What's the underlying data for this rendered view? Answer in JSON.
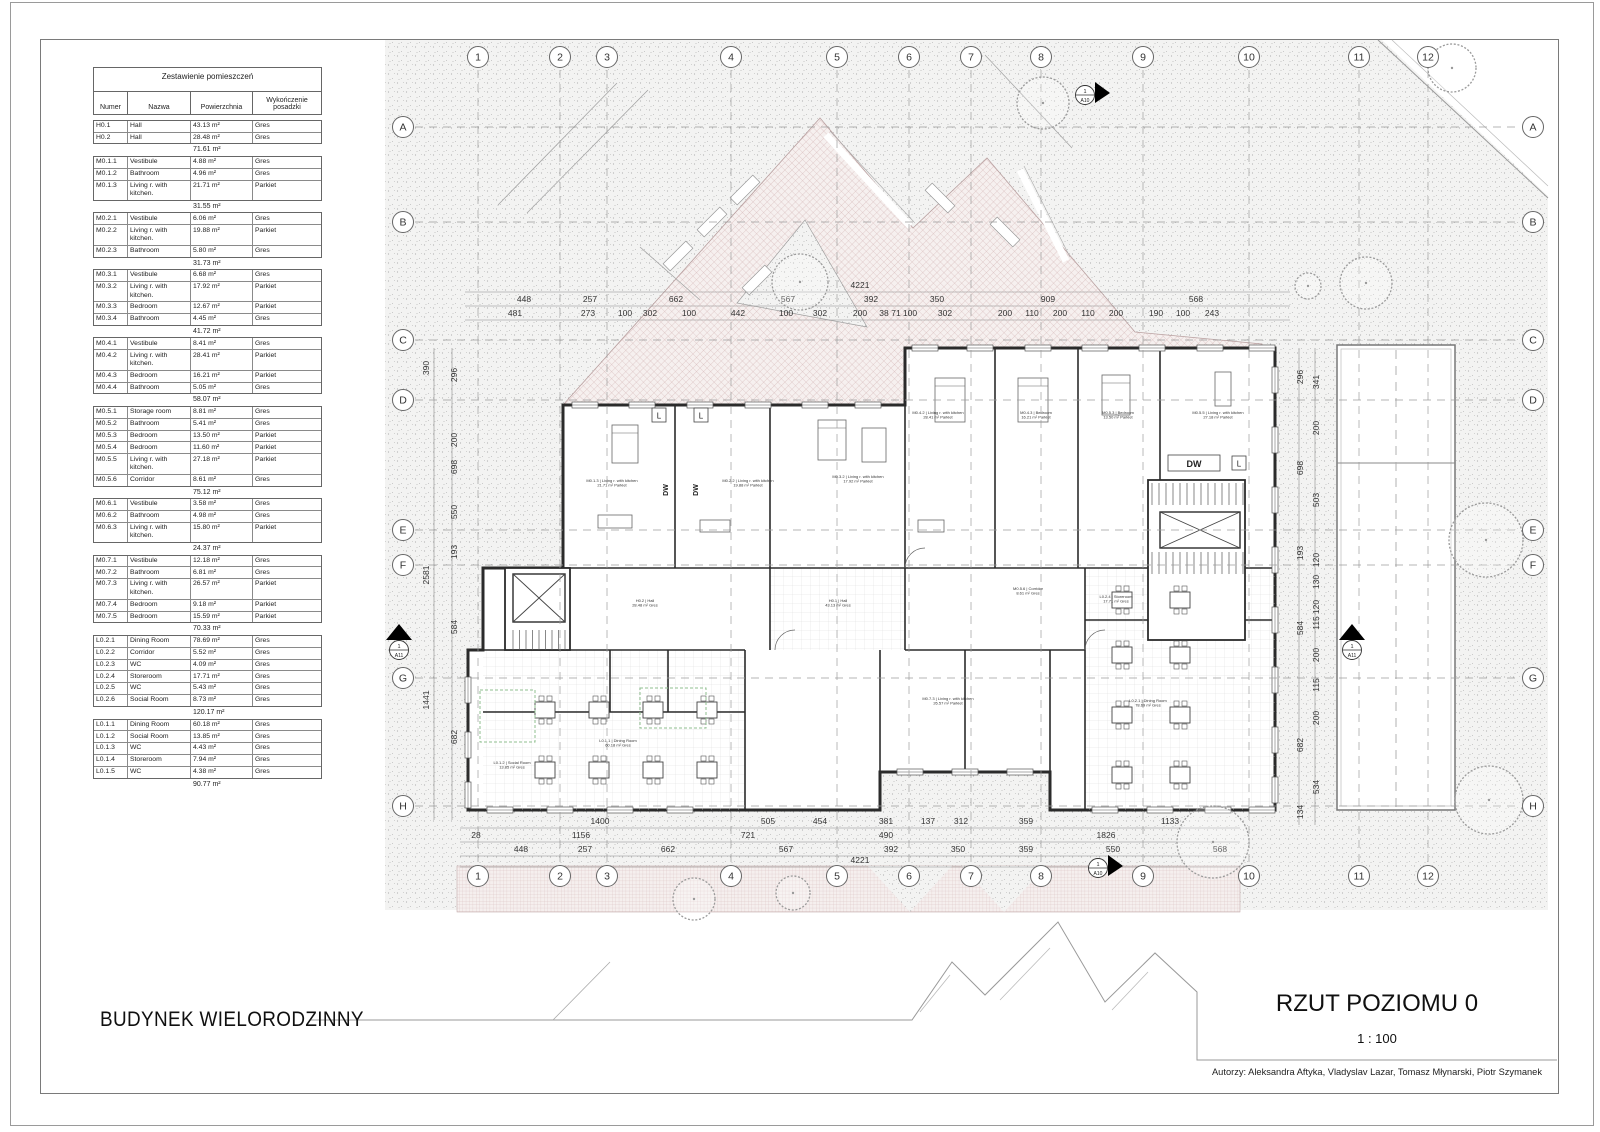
{
  "titles": {
    "project": "BUDYNEK WIELORODZINNY",
    "drawing": "RZUT POZIOMU 0",
    "scale": "1 : 100",
    "authors": "Autorzy: Aleksandra Aftyka, Vladyslav Lazar, Tomasz Młynarski, Piotr Szymanek"
  },
  "schedule": {
    "title": "Zestawienie pomieszczeń",
    "headers": [
      "Numer",
      "Nazwa",
      "Powierzchnia",
      "Wykończenie posadzki"
    ],
    "groups": [
      {
        "rows": [
          [
            "H0.1",
            "Hall",
            "43.13 m²",
            "Gres"
          ],
          [
            "H0.2",
            "Hall",
            "28.48 m²",
            "Gres"
          ]
        ],
        "subtotal": "71.61 m²"
      },
      {
        "rows": [
          [
            "M0.1.1",
            "Vestibule",
            "4.88 m²",
            "Gres"
          ],
          [
            "M0.1.2",
            "Bathroom",
            "4.96 m²",
            "Gres"
          ],
          [
            "M0.1.3",
            "Living r. with kitchen.",
            "21.71 m²",
            "Parkiet"
          ]
        ],
        "subtotal": "31.55 m²"
      },
      {
        "rows": [
          [
            "M0.2.1",
            "Vestibule",
            "6.06 m²",
            "Gres"
          ],
          [
            "M0.2.2",
            "Living r. with kitchen.",
            "19.88 m²",
            "Parkiet"
          ],
          [
            "M0.2.3",
            "Bathroom",
            "5.80 m²",
            "Gres"
          ]
        ],
        "subtotal": "31.73 m²"
      },
      {
        "rows": [
          [
            "M0.3.1",
            "Vestibule",
            "6.68 m²",
            "Gres"
          ],
          [
            "M0.3.2",
            "Living r. with kitchen.",
            "17.92 m²",
            "Parkiet"
          ],
          [
            "M0.3.3",
            "Bedroom",
            "12.67 m²",
            "Parkiet"
          ],
          [
            "M0.3.4",
            "Bathroom",
            "4.45 m²",
            "Gres"
          ]
        ],
        "subtotal": "41.72 m²"
      },
      {
        "rows": [
          [
            "M0.4.1",
            "Vestibule",
            "8.41 m²",
            "Gres"
          ],
          [
            "M0.4.2",
            "Living r. with kitchen.",
            "28.41 m²",
            "Parkiet"
          ],
          [
            "M0.4.3",
            "Bedroom",
            "16.21 m²",
            "Parkiet"
          ],
          [
            "M0.4.4",
            "Bathroom",
            "5.05 m²",
            "Gres"
          ]
        ],
        "subtotal": "58.07 m²"
      },
      {
        "rows": [
          [
            "M0.5.1",
            "Storage room",
            "8.81 m²",
            "Gres"
          ],
          [
            "M0.5.2",
            "Bathroom",
            "5.41 m²",
            "Gres"
          ],
          [
            "M0.5.3",
            "Bedroom",
            "13.50 m²",
            "Parkiet"
          ],
          [
            "M0.5.4",
            "Bedroom",
            "11.60 m²",
            "Parkiet"
          ],
          [
            "M0.5.5",
            "Living r. with kitchen.",
            "27.18 m²",
            "Parkiet"
          ],
          [
            "M0.5.6",
            "Corridor",
            "8.61 m²",
            "Gres"
          ]
        ],
        "subtotal": "75.12 m²"
      },
      {
        "rows": [
          [
            "M0.6.1",
            "Vestibule",
            "3.58 m²",
            "Gres"
          ],
          [
            "M0.6.2",
            "Bathroom",
            "4.98 m²",
            "Gres"
          ],
          [
            "M0.6.3",
            "Living r. with kitchen.",
            "15.80 m²",
            "Parkiet"
          ]
        ],
        "subtotal": "24.37 m²"
      },
      {
        "rows": [
          [
            "M0.7.1",
            "Vestibule",
            "12.18 m²",
            "Gres"
          ],
          [
            "M0.7.2",
            "Bathroom",
            "6.81 m²",
            "Gres"
          ],
          [
            "M0.7.3",
            "Living r. with kitchen.",
            "26.57 m²",
            "Parkiet"
          ],
          [
            "M0.7.4",
            "Bedroom",
            "9.18 m²",
            "Parkiet"
          ],
          [
            "M0.7.5",
            "Bedroom",
            "15.59 m²",
            "Parkiet"
          ]
        ],
        "subtotal": "70.33 m²"
      },
      {
        "rows": [
          [
            "L0.2.1",
            "Dining Room",
            "78.69 m²",
            "Gres"
          ],
          [
            "L0.2.2",
            "Corridor",
            "5.52 m²",
            "Gres"
          ],
          [
            "L0.2.3",
            "WC",
            "4.09 m²",
            "Gres"
          ],
          [
            "L0.2.4",
            "Storeroom",
            "17.71 m²",
            "Gres"
          ],
          [
            "L0.2.5",
            "WC",
            "5.43 m²",
            "Gres"
          ],
          [
            "L0.2.6",
            "Social Room",
            "8.73 m²",
            "Gres"
          ]
        ],
        "subtotal": "120.17 m²"
      },
      {
        "rows": [
          [
            "L0.1.1",
            "Dining Room",
            "60.18 m²",
            "Gres"
          ],
          [
            "L0.1.2",
            "Social Room",
            "13.85 m²",
            "Gres"
          ],
          [
            "L0.1.3",
            "WC",
            "4.43 m²",
            "Gres"
          ],
          [
            "L0.1.4",
            "Storeroom",
            "7.94 m²",
            "Gres"
          ],
          [
            "L0.1.5",
            "WC",
            "4.38 m²",
            "Gres"
          ]
        ],
        "subtotal": "90.77 m²"
      }
    ]
  },
  "grid": {
    "columns": [
      {
        "label": "1",
        "x": 478
      },
      {
        "label": "2",
        "x": 560
      },
      {
        "label": "3",
        "x": 607
      },
      {
        "label": "4",
        "x": 731
      },
      {
        "label": "5",
        "x": 837
      },
      {
        "label": "6",
        "x": 909
      },
      {
        "label": "7",
        "x": 971
      },
      {
        "label": "8",
        "x": 1041
      },
      {
        "label": "9",
        "x": 1143
      },
      {
        "label": "10",
        "x": 1249
      },
      {
        "label": "11",
        "x": 1359
      },
      {
        "label": "12",
        "x": 1428
      }
    ],
    "rows": [
      {
        "label": "A",
        "y": 127
      },
      {
        "label": "B",
        "y": 222
      },
      {
        "label": "C",
        "y": 340
      },
      {
        "label": "D",
        "y": 400
      },
      {
        "label": "E",
        "y": 530
      },
      {
        "label": "F",
        "y": 565
      },
      {
        "label": "G",
        "y": 678
      },
      {
        "label": "H",
        "y": 806
      }
    ]
  },
  "dimensions": {
    "top_total": {
      "t": "4221",
      "x": 860,
      "y": 288
    },
    "top_rows": [
      {
        "y": 302,
        "items": [
          [
            "448",
            524
          ],
          [
            "257",
            590
          ],
          [
            "662",
            676
          ],
          [
            "567",
            788
          ],
          [
            "392",
            871
          ],
          [
            "350",
            937
          ],
          [
            "909",
            1048
          ],
          [
            "568",
            1196
          ]
        ]
      },
      {
        "y": 316,
        "items": [
          [
            "481",
            515
          ],
          [
            "273",
            588
          ],
          [
            "100",
            625
          ],
          [
            "302",
            650
          ],
          [
            "100",
            689
          ],
          [
            "442",
            738
          ],
          [
            "100",
            786
          ],
          [
            "302",
            820
          ],
          [
            "200",
            860
          ],
          [
            "38",
            884
          ],
          [
            "71",
            896
          ],
          [
            "100",
            910
          ],
          [
            "302",
            945
          ],
          [
            "200",
            1005
          ],
          [
            "110",
            1032
          ],
          [
            "200",
            1060
          ],
          [
            "110",
            1088
          ],
          [
            "200",
            1116
          ],
          [
            "190",
            1156
          ],
          [
            "100",
            1183
          ],
          [
            "243",
            1212
          ]
        ]
      }
    ],
    "bottom_rows": [
      {
        "y": 824,
        "items": [
          [
            "1400",
            600
          ],
          [
            "505",
            768
          ],
          [
            "454",
            820
          ],
          [
            "381",
            886
          ],
          [
            "137",
            928
          ],
          [
            "312",
            961
          ],
          [
            "359",
            1026
          ],
          [
            "1133",
            1170
          ]
        ]
      },
      {
        "y": 838,
        "items": [
          [
            "28",
            476
          ],
          [
            "1156",
            581
          ],
          [
            "721",
            748
          ],
          [
            "490",
            886
          ],
          [
            "1826",
            1106
          ]
        ]
      },
      {
        "y": 852,
        "items": [
          [
            "448",
            521
          ],
          [
            "257",
            585
          ],
          [
            "662",
            668
          ],
          [
            "567",
            786
          ],
          [
            "392",
            891
          ],
          [
            "350",
            958
          ],
          [
            "359",
            1026
          ],
          [
            "550",
            1113
          ],
          [
            "568",
            1220
          ]
        ]
      }
    ],
    "bottom_total": {
      "t": "4221",
      "x": 860,
      "y": 863
    },
    "left_cols": [
      {
        "x": 429,
        "items": [
          [
            "390",
            368
          ],
          [
            "2581",
            575
          ],
          [
            "1441",
            700
          ]
        ]
      },
      {
        "x": 457,
        "items": [
          [
            "296",
            375
          ],
          [
            "200",
            440
          ],
          [
            "698",
            467
          ],
          [
            "550",
            512
          ],
          [
            "193",
            552
          ],
          [
            "584",
            627
          ],
          [
            "682",
            737
          ]
        ]
      }
    ],
    "right_cols": [
      {
        "x": 1303,
        "items": [
          [
            "296",
            377
          ],
          [
            "698",
            468
          ],
          [
            "193",
            553
          ],
          [
            "584",
            628
          ],
          [
            "682",
            745
          ],
          [
            "134",
            812
          ]
        ]
      },
      {
        "x": 1319,
        "items": [
          [
            "341",
            382
          ],
          [
            "200",
            428
          ],
          [
            "503",
            500
          ],
          [
            "120",
            560
          ],
          [
            "130",
            582
          ],
          [
            "120",
            607
          ],
          [
            "115",
            623
          ],
          [
            "200",
            655
          ],
          [
            "115",
            685
          ],
          [
            "200",
            718
          ],
          [
            "534",
            787
          ]
        ]
      }
    ]
  },
  "markers": [
    {
      "num": "1",
      "code": "A10",
      "x": 1085,
      "y": 95,
      "dir": "right"
    },
    {
      "num": "1",
      "code": "A10",
      "x": 1098,
      "y": 868,
      "dir": "right"
    },
    {
      "num": "1",
      "code": "A11",
      "x": 399,
      "y": 650,
      "dir": "up"
    },
    {
      "num": "1",
      "code": "A11",
      "x": 1352,
      "y": 650,
      "dir": "up"
    }
  ],
  "trees": [
    {
      "x": 1043,
      "y": 103,
      "r": 26
    },
    {
      "x": 1452,
      "y": 68,
      "r": 24
    },
    {
      "x": 800,
      "y": 282,
      "r": 28
    },
    {
      "x": 1308,
      "y": 286,
      "r": 13
    },
    {
      "x": 1366,
      "y": 283,
      "r": 26
    },
    {
      "x": 1486,
      "y": 540,
      "r": 37
    },
    {
      "x": 1489,
      "y": 800,
      "r": 34
    },
    {
      "x": 1213,
      "y": 842,
      "r": 36
    },
    {
      "x": 694,
      "y": 899,
      "r": 21
    },
    {
      "x": 793,
      "y": 893,
      "r": 17
    }
  ],
  "fixtures": {
    "dw": "DW",
    "l": "L"
  },
  "plan_labels": [
    {
      "t1": "M0.1.3 | Living r. with kitchen",
      "t2": "21.71 m² Parkiet",
      "x": 612,
      "y": 482
    },
    {
      "t1": "M0.2.2 | Living r. with kitchen",
      "t2": "19.88 m² Parkiet",
      "x": 748,
      "y": 482
    },
    {
      "t1": "M0.3.2 | Living r. with kitchen",
      "t2": "17.92 m² Parkiet",
      "x": 858,
      "y": 478
    },
    {
      "t1": "M0.4.2 | Living r. with kitchen",
      "t2": "28.41 m² Parkiet",
      "x": 938,
      "y": 414
    },
    {
      "t1": "M0.4.3 | Bedroom",
      "t2": "16.21 m² Parkiet",
      "x": 1036,
      "y": 414
    },
    {
      "t1": "M0.5.3 | Bedroom",
      "t2": "13.50 m² Parkiet",
      "x": 1118,
      "y": 414
    },
    {
      "t1": "M0.5.5 | Living r. with kitchen",
      "t2": "27.18 m² Parkiet",
      "x": 1218,
      "y": 414
    },
    {
      "t1": "M0.5.6 | Corridor",
      "t2": "8.61 m² Gres",
      "x": 1028,
      "y": 590
    },
    {
      "t1": "H0.1 | Hall",
      "t2": "43.13 m² Gres",
      "x": 838,
      "y": 602
    },
    {
      "t1": "H0.2 | Hall",
      "t2": "28.48 m² Gres",
      "x": 645,
      "y": 602
    },
    {
      "t1": "L0.1.1 | Dining Room",
      "t2": "60.18 m² Gres",
      "x": 618,
      "y": 742
    },
    {
      "t1": "L0.1.2 | Social Room",
      "t2": "13.85 m² Gres",
      "x": 512,
      "y": 764
    },
    {
      "t1": "L0.2.1 | Dining Room",
      "t2": "78.69 m² Gres",
      "x": 1148,
      "y": 702
    },
    {
      "t1": "L0.2.4 | Storeroom",
      "t2": "17.71 m² Gres",
      "x": 1116,
      "y": 598
    },
    {
      "t1": "M0.7.3 | Living r. with kitchen",
      "t2": "26.57 m² Parkiet",
      "x": 948,
      "y": 700
    }
  ]
}
